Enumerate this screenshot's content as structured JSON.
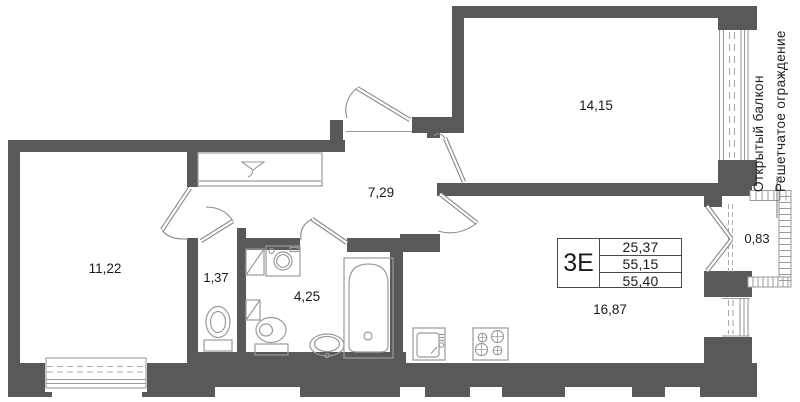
{
  "plan": {
    "title": "apartment floor plan",
    "rooms": {
      "bedroom_left": {
        "area": "11,22"
      },
      "hall": {
        "area": "7,29"
      },
      "bedroom_top": {
        "area": "14,15"
      },
      "living_kitchen": {
        "area": "16,87"
      },
      "wc": {
        "area": "1,37"
      },
      "bathroom": {
        "area": "4,25"
      },
      "balcony": {
        "area": "0,83"
      }
    },
    "info_table": {
      "type_label": "3Е",
      "values": [
        "25,37",
        "55,15",
        "55,40"
      ]
    },
    "annotations": {
      "open_balcony": "Открытый балкон",
      "lattice_fence": "Решетчатое ограждение"
    },
    "icons": [
      "coat-hanger-icon",
      "vent-shaft-icon",
      "washing-machine-icon",
      "bathtub-icon",
      "toilet-icon",
      "pedestal-sink-icon",
      "kitchen-sink-icon",
      "stove-icon"
    ],
    "colors": {
      "wall": "#595959",
      "fixture_line": "#9a9a9a",
      "door_line": "#8c8c8c",
      "text": "#1a1a1a"
    }
  }
}
